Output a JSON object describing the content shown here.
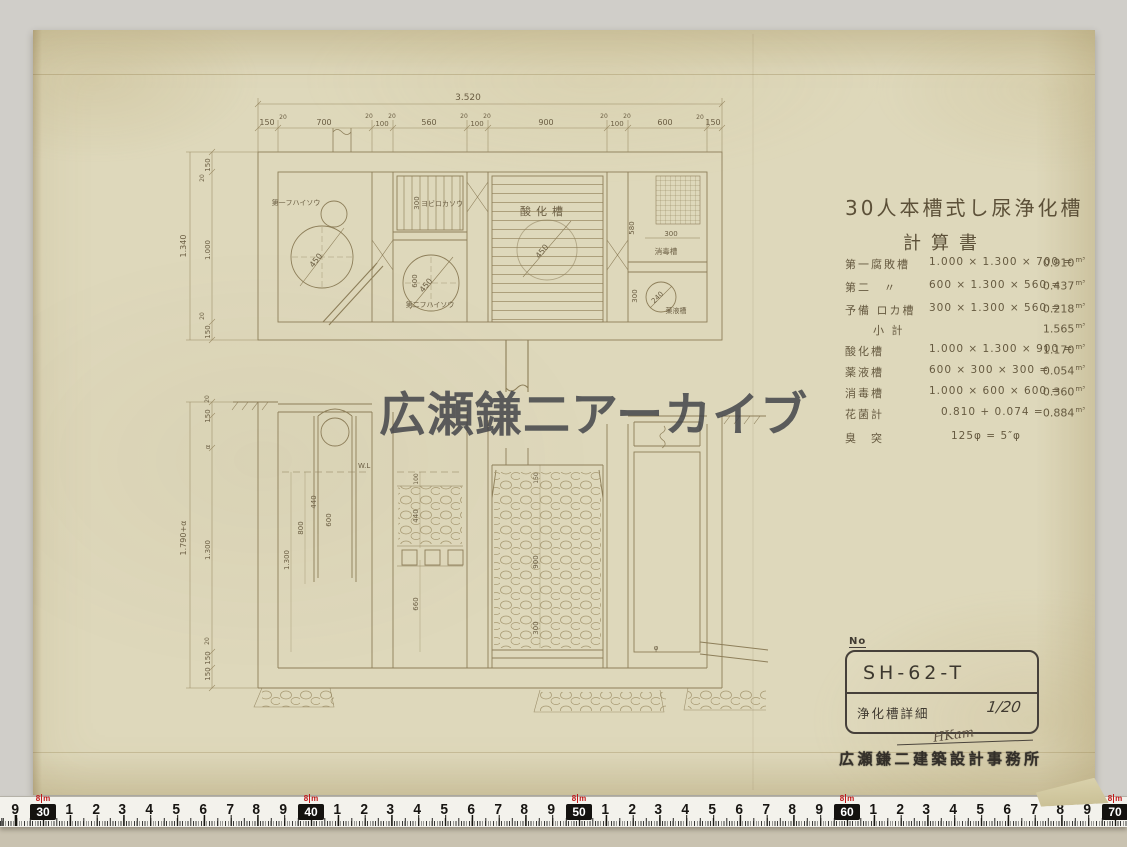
{
  "watermark": "広瀬鎌二アーカイブ",
  "colors": {
    "paper": "#ded8bb",
    "background": "#d0cec9",
    "ink": "#8d7e59",
    "ruler_red": "#c01818"
  },
  "calc_sheet": {
    "title": "30人本槽式し尿浄化槽",
    "subtitle": "計算書",
    "rows": [
      {
        "label": "第一腐敗槽",
        "formula": "1.000 × 1.300 × 700 =",
        "value": "0.910",
        "unit": "m³"
      },
      {
        "label": "第二　〃",
        "formula": "600 × 1.300 × 560 =",
        "value": "0.437",
        "unit": "m³"
      },
      {
        "label": "予備 ロカ槽",
        "formula": "300 × 1.300 × 560 =",
        "value": "0.218",
        "unit": "m³"
      },
      {
        "label": "小 計",
        "formula": "",
        "value": "1.565",
        "unit": "m³"
      },
      {
        "label": "酸化槽",
        "formula": "1.000 × 1.300 × 900 =",
        "value": "1.170",
        "unit": "m³"
      },
      {
        "label": "薬液槽",
        "formula": "600 × 300 × 300 =",
        "value": "0.054",
        "unit": "m³"
      },
      {
        "label": "消毒槽",
        "formula": "1.000 × 600 × 600 =",
        "value": "0.360",
        "unit": "m³"
      },
      {
        "label": "花菌計",
        "formula": "0.810 + 0.074 =",
        "value": "0.884",
        "unit": "m³"
      },
      {
        "label": "臭　突",
        "formula": "125φ = 5″φ",
        "value": "",
        "unit": ""
      }
    ]
  },
  "title_block": {
    "no_label": "No",
    "code": "SH-62-T",
    "name": "浄化槽詳細",
    "scale": "1/20",
    "signature": "HKam",
    "stamp": "広瀬鎌二建築設計事務所"
  },
  "ruler": {
    "meter_label": "8",
    "meter_unit": "m",
    "decimeters": [
      "30",
      "40",
      "50",
      "60",
      "70"
    ],
    "cm_digits": [
      "1",
      "2",
      "3",
      "4",
      "5",
      "6",
      "7",
      "8",
      "9"
    ],
    "leading_digit": "9"
  },
  "drawing": {
    "plan": {
      "total": "3.520",
      "top_chain": [
        "150",
        "20",
        "700",
        "20",
        "100",
        "20",
        "560",
        "20",
        "100",
        "20",
        "900",
        "20",
        "100",
        "20",
        "600",
        "20",
        "150"
      ],
      "left_total": "1.340",
      "left_chain": [
        "150",
        "20",
        "1.000",
        "20",
        "150"
      ],
      "c1_label": "第一フハイソウ",
      "c1_dia": "450",
      "yobi_label": "ヨビロカソウ",
      "yobi_dim": "300",
      "c2_label": "第二フハイソウ",
      "c2_dia": "450",
      "c2_height": "600",
      "oxid_label": "酸化槽",
      "oxid_dia": "450",
      "dis_label": "消毒槽",
      "dis_height": "580",
      "dis_width": "300",
      "chem_label": "薬液槽",
      "chem_height": "300",
      "chem_dia": "240"
    },
    "section": {
      "left_total": "1.790+α",
      "left_chain": [
        "20",
        "150",
        "α",
        "1.300",
        "20",
        "150",
        "150"
      ],
      "water_level": "W.L",
      "a_dims": [
        "440",
        "800",
        "600",
        "1.300"
      ],
      "b_dims": [
        "100",
        "440",
        "660"
      ],
      "c_dims": [
        "150",
        "900",
        "300"
      ],
      "outlet_dia": "φ"
    }
  }
}
